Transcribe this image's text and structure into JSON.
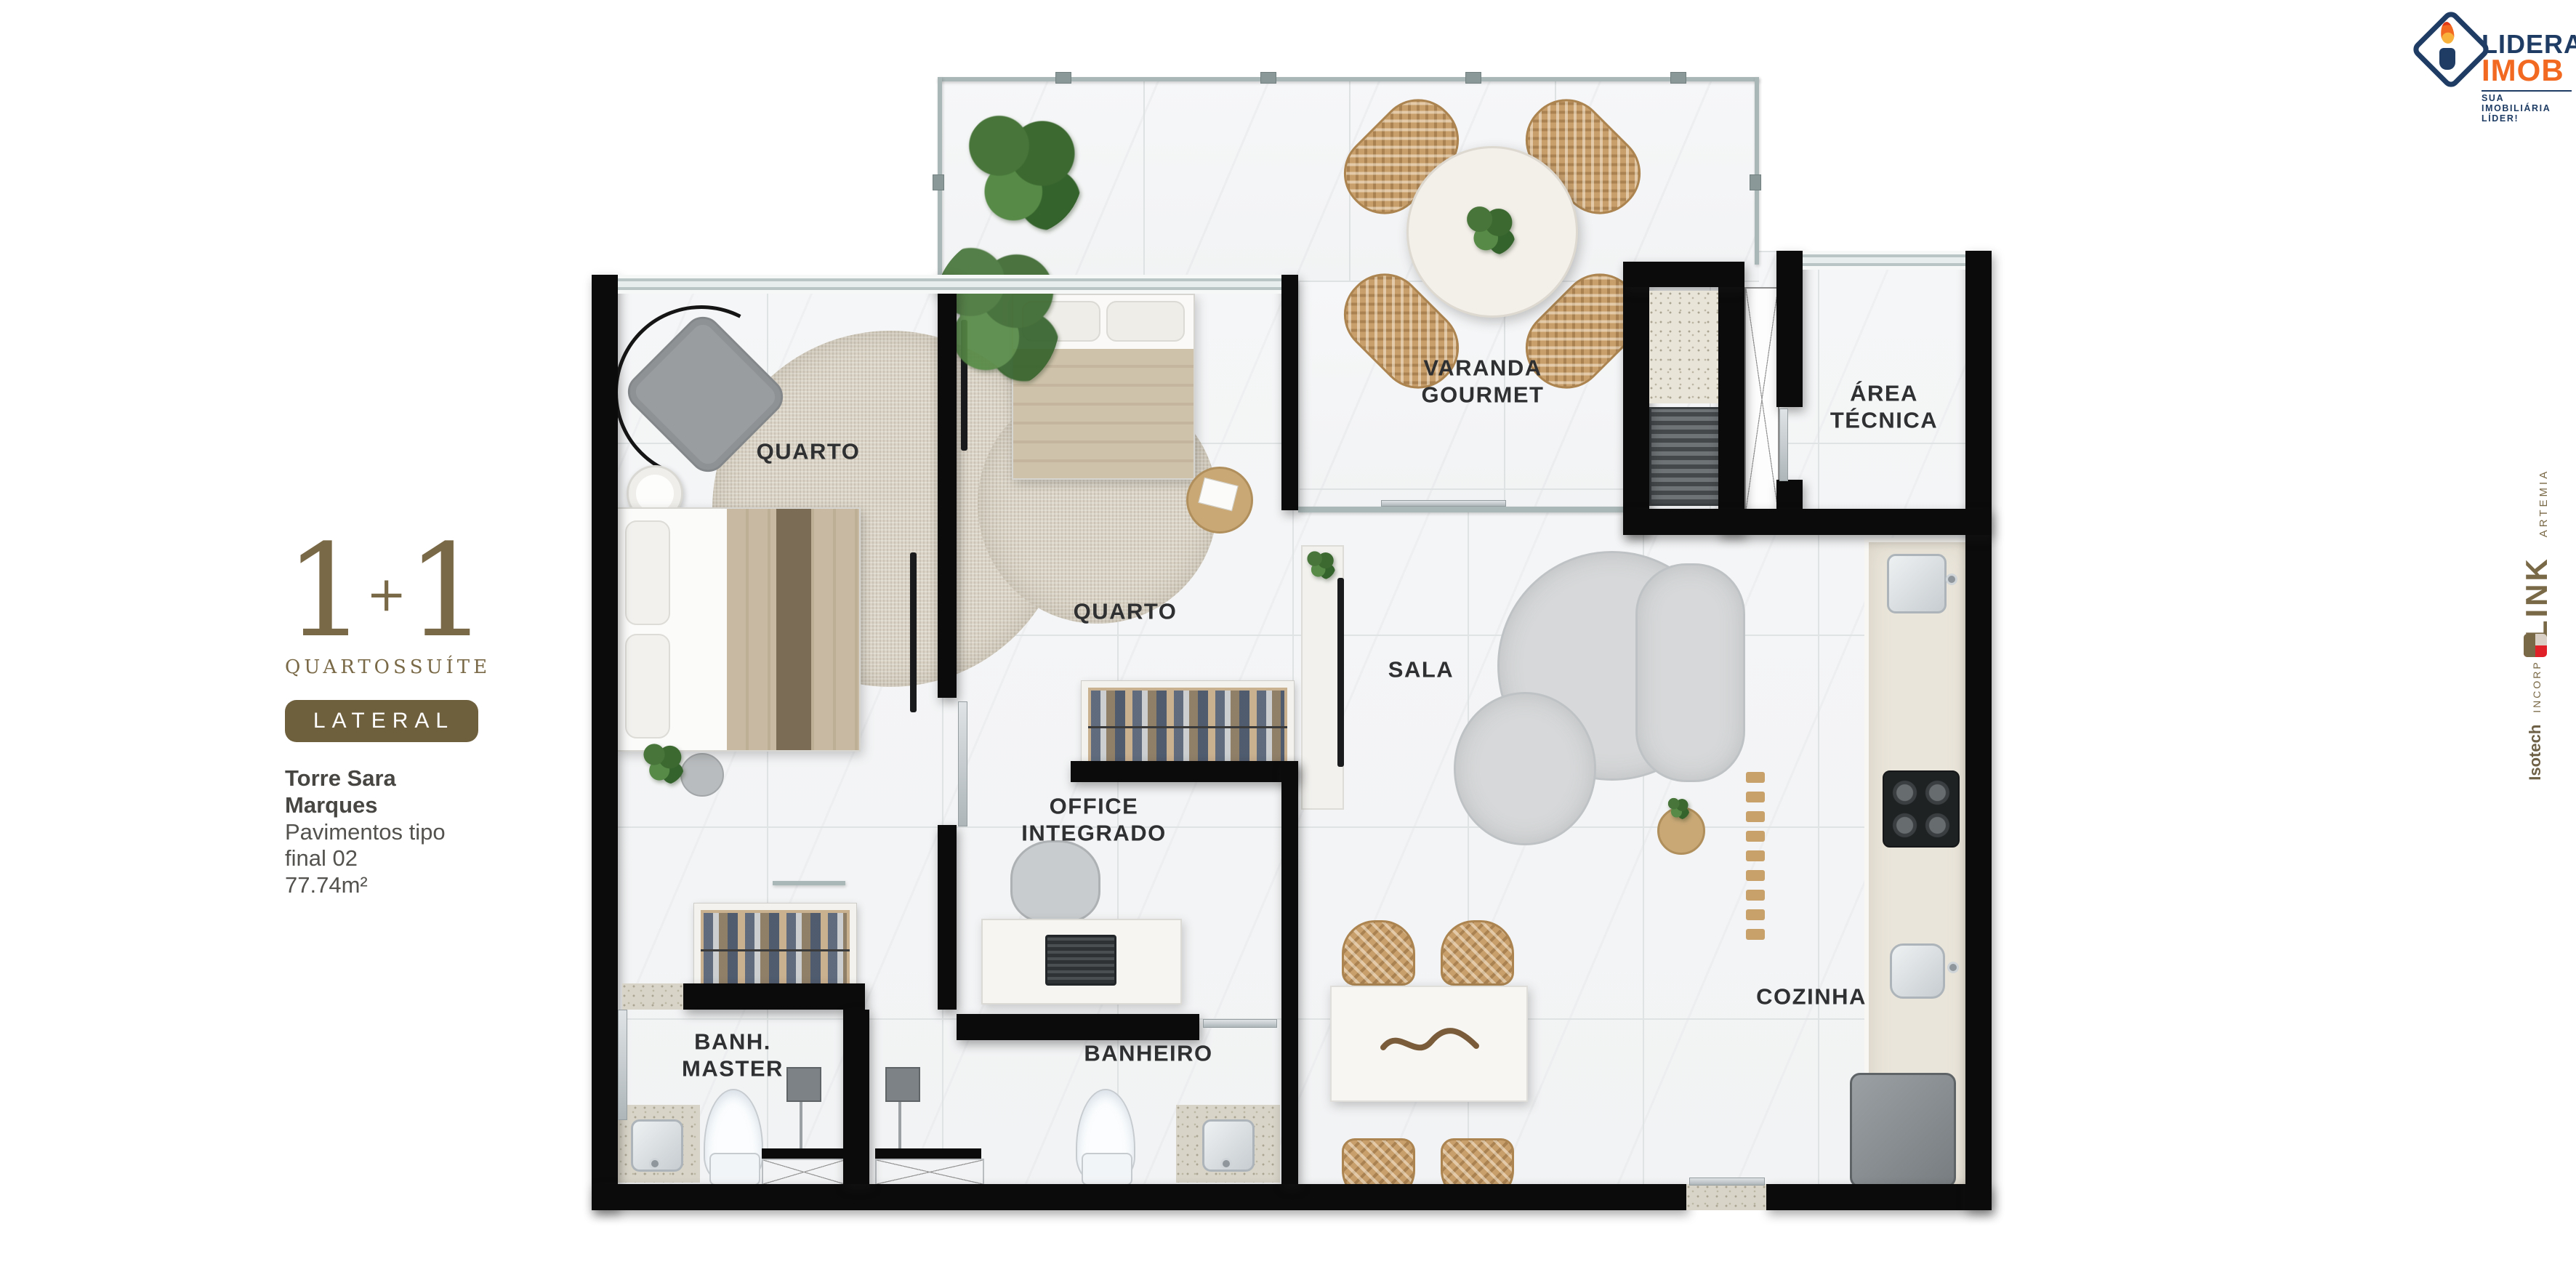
{
  "info_panel": {
    "quartos_count": "1",
    "plus": "+",
    "suite_count": "1",
    "quartos_label": "QUARTOS",
    "suite_label": "SUÍTE",
    "position_badge": "LATERAL",
    "tower": "Torre Sara Marques",
    "floors": "Pavimentos tipo final 02",
    "area": "77.74m²"
  },
  "rooms": {
    "varanda": "VARANDA\nGOURMET",
    "area_tecnica": "ÁREA\nTÉCNICA",
    "quarto1": "QUARTO",
    "quarto2": "QUARTO",
    "sala": "SALA",
    "office": "OFFICE\nINTEGRADO",
    "banh_master": "BANH.\nMASTER",
    "banheiro": "BANHEIRO",
    "cozinha": "COZINHA"
  },
  "branding": {
    "logo": {
      "line1": "LIDERA",
      "line2": "IMOB",
      "tagline": "SUA IMOBILIÁRIA LÍDER!"
    },
    "side": {
      "link": "LINK",
      "artemia": "ARTEMIA",
      "isotech": "Isotech",
      "incorp": "INCORP"
    }
  },
  "colors": {
    "accent_brown": "#7a6946",
    "badge_brown": "#6e5f3d",
    "logo_navy": "#1e3c64",
    "logo_orange": "#f26a21",
    "brand_red": "#e02127",
    "wall_black": "#0b0b0b"
  }
}
